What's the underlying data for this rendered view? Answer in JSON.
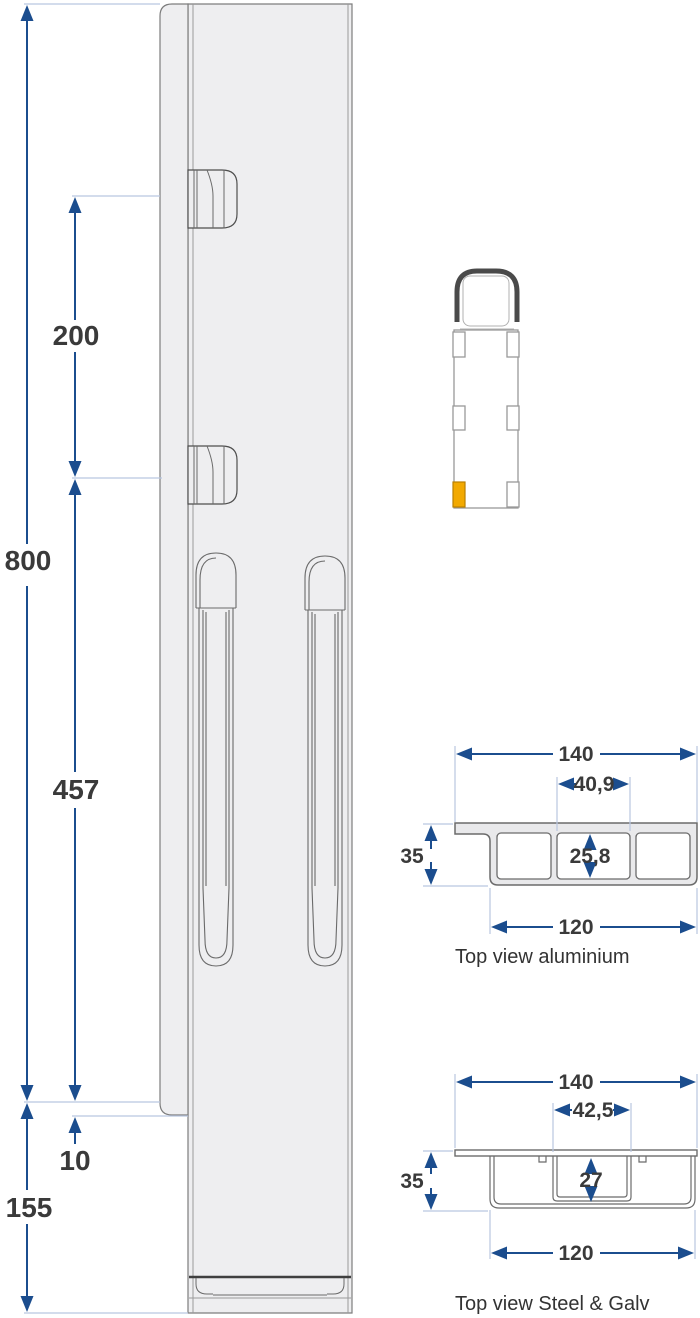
{
  "side_view": {
    "dim_total_height": "800",
    "dim_pocket_spacing": "200",
    "dim_slot_section": "457",
    "dim_plate_offset": "10",
    "dim_lower_section": "155"
  },
  "aluminium_section": {
    "label": "Top view aluminium",
    "dim_overall_width": "140",
    "dim_center_pocket_width": "40,9",
    "dim_profile_height": "35",
    "dim_center_pocket_depth": "25,8",
    "dim_body_width": "120"
  },
  "steel_section": {
    "label": "Top view Steel & Galv",
    "dim_overall_width": "140",
    "dim_center_pocket_width": "42,5",
    "dim_profile_height": "35",
    "dim_center_pocket_depth": "27",
    "dim_body_width": "120"
  },
  "colors": {
    "dimension_blue": "#1b4d8e",
    "extension_blue": "#b9c6e0",
    "marker_orange": "#f2a900",
    "text_dark": "#3a3a3a",
    "part_fill": "#eeeef0",
    "outline_gray": "#6e6e6e"
  }
}
